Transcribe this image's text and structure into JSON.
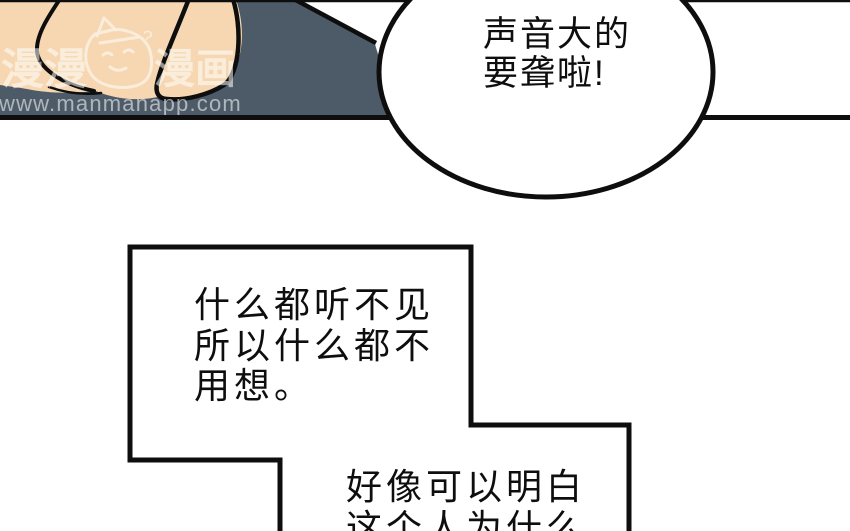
{
  "page": {
    "kind": "comic-reader-page",
    "width": 850,
    "height": 531
  },
  "colors": {
    "paper": "#ffffff",
    "panel_gray": "#4d5b68",
    "skin": "#f6d7b1",
    "ink": "#0e0e0e",
    "bubble_fill": "#ffffff",
    "watermark": "#ffffff"
  },
  "watermark": {
    "brand_left": "漫漫",
    "brand_right": "漫画",
    "url": "www.manmanapp.com",
    "mascot": "mascot-doodle-icon",
    "squiggle": "?"
  },
  "dialogue": {
    "bubble_shout": "声音大的\n要聋啦!",
    "box_thought_1": "什么都听不见\n所以什么都不\n用想。",
    "box_thought_2": "好像可以明白\n这个人为什么"
  }
}
